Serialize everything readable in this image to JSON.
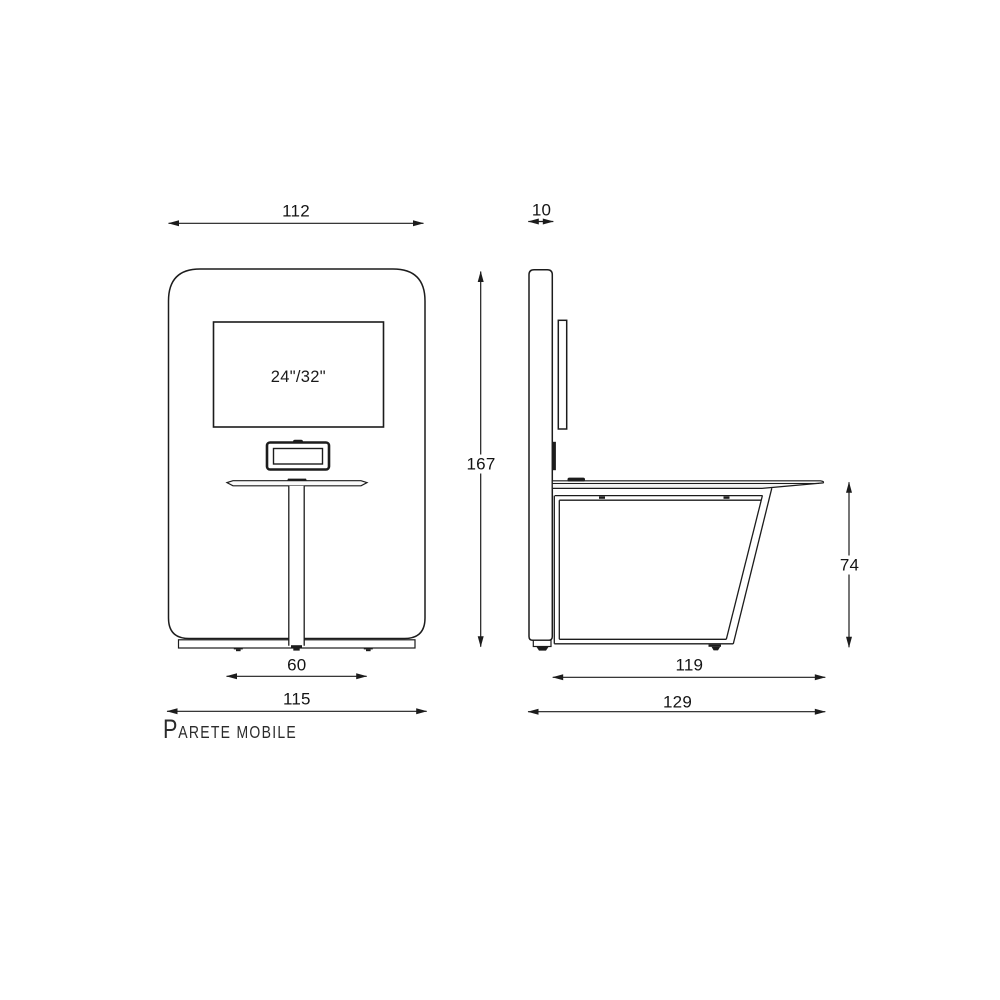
{
  "drawing_title": {
    "initial": "P",
    "rest": "ARETE MOBILE"
  },
  "front_view": {
    "screen_size_label": "24\"/32\"",
    "dim_width": "112",
    "dim_height": "167",
    "dim_table_width": "60",
    "dim_base_width": "115"
  },
  "side_view": {
    "dim_panel_thickness": "10",
    "dim_table_height": "74",
    "dim_frame_depth": "119",
    "dim_total_depth": "129"
  },
  "colors": {
    "line": "#1c1c1c",
    "text": "#141414",
    "background": "#ffffff",
    "tabletop_fill": "#f4f4f4"
  }
}
